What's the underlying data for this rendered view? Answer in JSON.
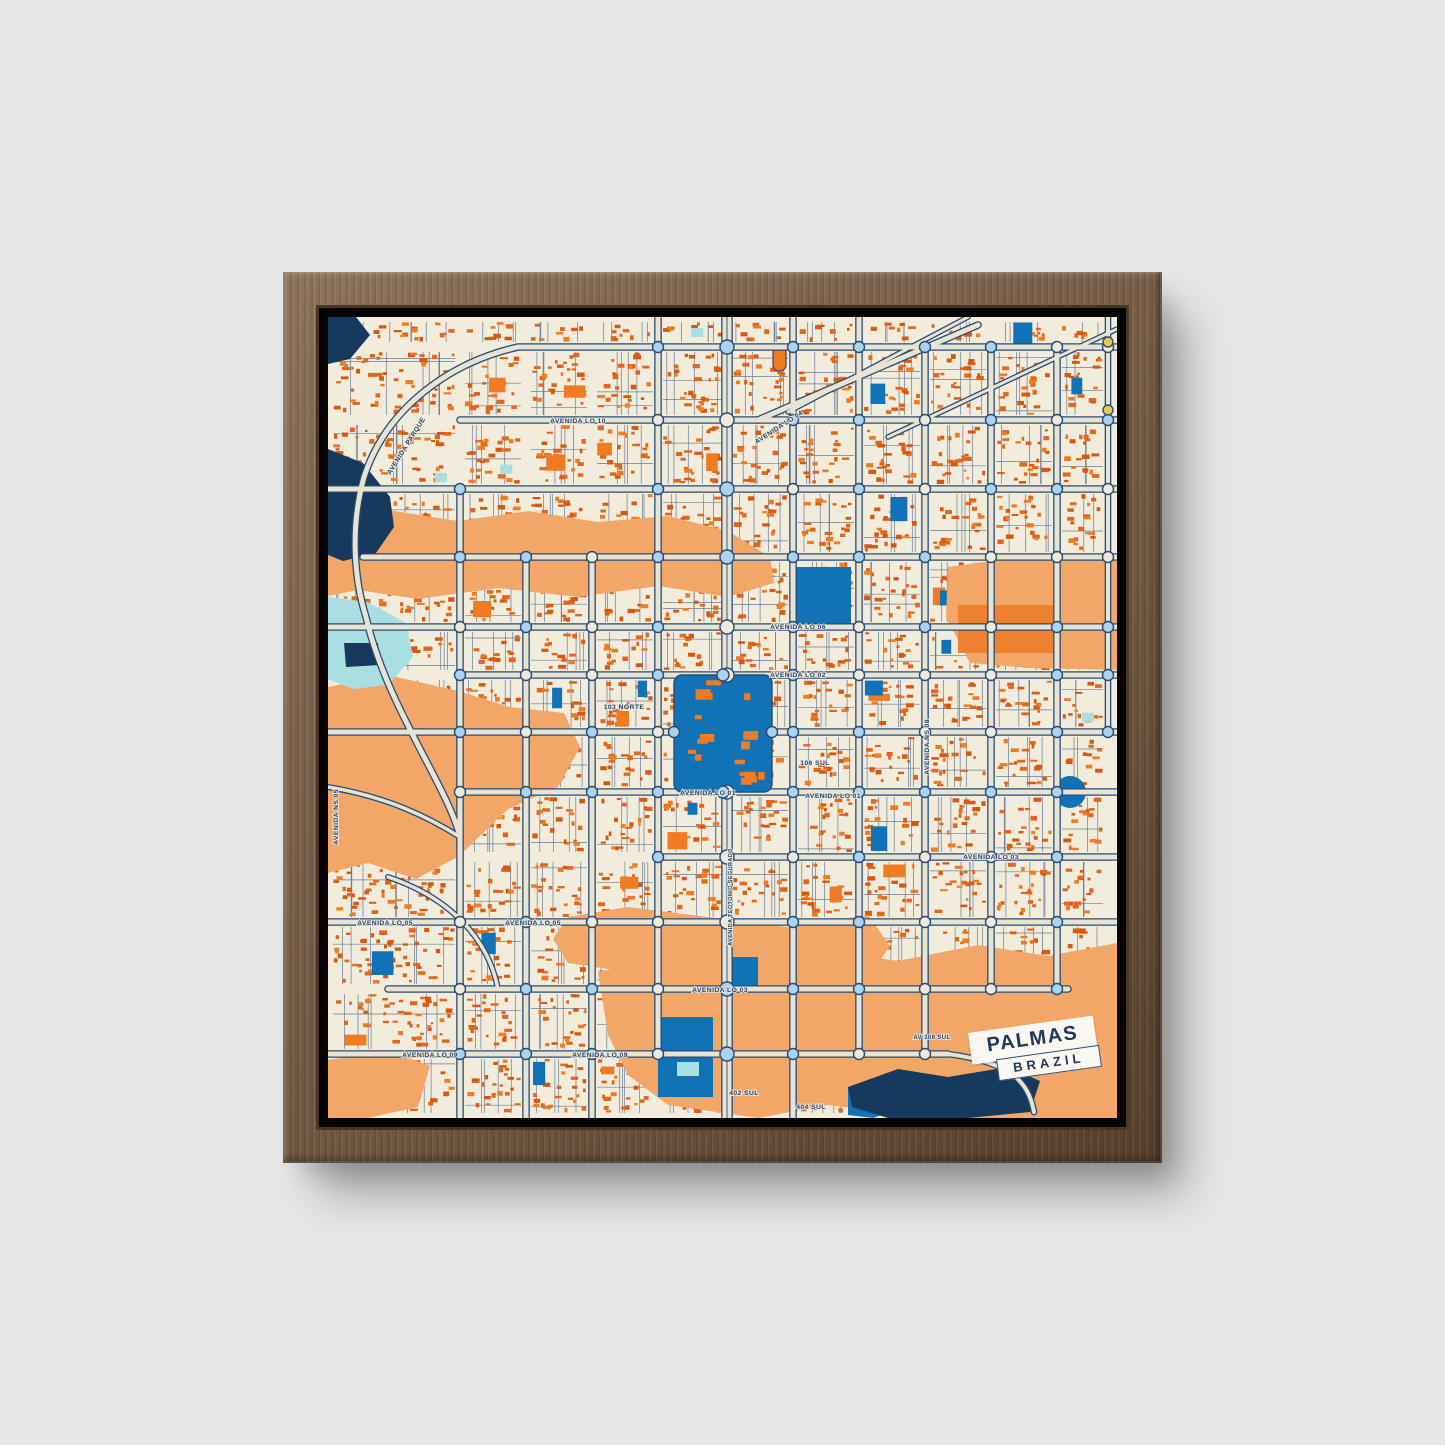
{
  "scene": {
    "wall_color": "#e7e7e7",
    "frame_wood_color": "#6e5640",
    "frame_gap_color": "#120c07"
  },
  "map": {
    "title_card": {
      "title": "PALMAS",
      "subtitle": "BRAZIL"
    },
    "seed": 20240718,
    "palette": {
      "cream": "#f1ecdc",
      "minor_road": "#51688c",
      "building1": "#e2661c",
      "building2": "#d8580e",
      "building3": "#ef7b22",
      "blue": "#1173b6",
      "cyan": "#a9dfe0",
      "navy": "#17395e",
      "orange": "#f2a768",
      "orange_dark": "#ee8130",
      "road_fill": "#e8e4d4",
      "casing": "#2b4b72",
      "roundabout": "#a9d3ee",
      "roundabout_alt": "#efe9d9",
      "yellow": "#e9c94e",
      "label": "#24426e"
    },
    "patches": [
      {
        "c": "orange",
        "pts": "0,205 60,193 130,204 200,194 270,205 340,199 400,214 442,240 446,266 400,280 330,269 250,280 170,271 90,282 30,273 0,279"
      },
      {
        "c": "orange",
        "pts": "620,250 700,239 789,237 789,353 700,351 642,346 618,300"
      },
      {
        "c": "orange",
        "pts": "0,370 60,358 130,374 182,390 236,396 252,430 230,470 180,492 130,540 88,562 40,546 0,556"
      },
      {
        "c": "orange",
        "pts": "225,622 240,600 300,590 380,600 460,610 540,598 562,629 540,660 460,650 380,662 300,655 240,646"
      },
      {
        "c": "orange",
        "pts": "270,655 350,638 430,649 500,633 570,644 650,628 720,639 789,626 789,801 600,801 500,788 430,801 340,788 300,758 280,718"
      },
      {
        "c": "orange",
        "pts": "0,743 60,733 102,749 90,790 40,801 0,801"
      },
      {
        "c": "navy",
        "pts": "0,0 28,0 42,18 22,42 0,47"
      },
      {
        "c": "navy",
        "pts": "0,132 35,146 62,180 66,210 48,236 15,244 0,238"
      },
      {
        "c": "cyan",
        "pts": "0,280 40,285 78,306 85,340 60,368 25,372 0,362"
      },
      {
        "c": "navy",
        "pts": "16,326 50,326 52,348 18,350"
      },
      {
        "c": "blue",
        "pts": "520,770 560,757 577,790 545,801 520,798"
      },
      {
        "c": "navy",
        "pts": "520,770 570,752 620,760 680,750 712,764 702,795 640,801 560,801 524,790"
      }
    ],
    "shapes": [
      {
        "type": "rect",
        "x": 630,
        "y": 288,
        "w": 95,
        "h": 48,
        "c": "orange_dark"
      },
      {
        "type": "rect",
        "x": 468,
        "y": 250,
        "w": 55,
        "h": 58,
        "c": "blue"
      },
      {
        "type": "rect",
        "x": 330,
        "y": 700,
        "w": 55,
        "h": 80,
        "c": "blue"
      },
      {
        "type": "rect",
        "x": 404,
        "y": 640,
        "w": 26,
        "h": 30,
        "c": "blue"
      },
      {
        "type": "rect",
        "x": 349,
        "y": 745,
        "w": 22,
        "h": 14,
        "c": "cyan"
      },
      {
        "type": "circle",
        "cx": 742,
        "cy": 475,
        "r": 16,
        "c": "blue"
      },
      {
        "type": "rect",
        "x": 445,
        "y": 28,
        "w": 13,
        "h": 26,
        "c": "building3",
        "rx": 6,
        "stroke": 1
      }
    ],
    "roads": {
      "horizontals": [
        {
          "y": 30,
          "x0": 190,
          "x1": 789,
          "w": 5
        },
        {
          "y": 103,
          "x0": 132,
          "x1": 789,
          "w": 5
        },
        {
          "y": 172,
          "x0": 0,
          "x1": 789,
          "w": 5
        },
        {
          "y": 240,
          "x0": 35,
          "x1": 789,
          "w": 5
        },
        {
          "y": 310,
          "x0": 0,
          "x1": 789,
          "w": 5
        },
        {
          "y": 358,
          "x0": 132,
          "x1": 789,
          "w": 5
        },
        {
          "y": 415,
          "x0": 0,
          "x1": 346,
          "w": 5
        },
        {
          "y": 415,
          "x0": 444,
          "x1": 789,
          "w": 5
        },
        {
          "y": 475,
          "x0": 132,
          "x1": 789,
          "w": 5
        },
        {
          "y": 540,
          "x0": 330,
          "x1": 789,
          "w": 5
        },
        {
          "y": 605,
          "x0": 0,
          "x1": 789,
          "w": 5
        },
        {
          "y": 672,
          "x0": 60,
          "x1": 740,
          "w": 5
        },
        {
          "y": 737,
          "x0": 0,
          "x1": 620,
          "w": 5
        }
      ],
      "verticals": [
        {
          "x": 132,
          "y0": 172,
          "y1": 801,
          "w": 5
        },
        {
          "x": 198,
          "y0": 240,
          "y1": 801,
          "w": 5
        },
        {
          "x": 264,
          "y0": 240,
          "y1": 801,
          "w": 5
        },
        {
          "x": 330,
          "y0": 0,
          "y1": 737,
          "w": 5
        },
        {
          "x": 399,
          "y0": 0,
          "y1": 801,
          "w": 9
        },
        {
          "x": 465,
          "y0": 0,
          "y1": 801,
          "w": 5
        },
        {
          "x": 531,
          "y0": 0,
          "y1": 737,
          "w": 5
        },
        {
          "x": 597,
          "y0": 30,
          "y1": 737,
          "w": 5
        },
        {
          "x": 663,
          "y0": 30,
          "y1": 672,
          "w": 5
        },
        {
          "x": 729,
          "y0": 30,
          "y1": 672,
          "w": 5
        },
        {
          "x": 780,
          "y0": 0,
          "y1": 415,
          "w": 4
        }
      ],
      "curves": [
        {
          "d": "M190,30 C120,46 58,92 36,160 C22,210 26,262 38,300 C58,388 120,470 132,520",
          "w": 5
        },
        {
          "d": "M430,103 L650,8",
          "w": 5
        },
        {
          "d": "M460,95 L640,0",
          "w": 3
        },
        {
          "d": "M560,120 L789,12",
          "w": 3
        },
        {
          "d": "M60,560 C120,580 160,620 170,672",
          "w": 3.5
        },
        {
          "d": "M0,470 C60,480 100,500 132,520",
          "w": 3.5
        },
        {
          "d": "M620,737 C680,745 700,762 706,795",
          "w": 4
        }
      ]
    },
    "central_square": {
      "x": 346,
      "y": 358,
      "w": 98,
      "h": 117
    },
    "extra_roundabouts": [
      {
        "x": 346,
        "y": 415,
        "r": 5.5
      },
      {
        "x": 444,
        "y": 415,
        "r": 5.5
      },
      {
        "x": 395,
        "y": 358,
        "r": 6
      },
      {
        "x": 395,
        "y": 475,
        "r": 6
      },
      {
        "x": 780,
        "y": 25,
        "r": 5,
        "fill": "yellow"
      },
      {
        "x": 780,
        "y": 93,
        "r": 5,
        "fill": "yellow"
      }
    ],
    "street_labels": [
      {
        "t": "AVENIDA LO 10",
        "x": 250,
        "y": 106
      },
      {
        "t": "AVENIDA LO 04",
        "x": 452,
        "y": 112,
        "rot": -33
      },
      {
        "t": "AVENIDA PARQUE",
        "x": 80,
        "y": 130,
        "rot": -58
      },
      {
        "t": "AVENIDA LO 06",
        "x": 470,
        "y": 312
      },
      {
        "t": "AVENIDA LO 02",
        "x": 470,
        "y": 360
      },
      {
        "t": "103 NORTE",
        "x": 296,
        "y": 392
      },
      {
        "t": "106 SUL",
        "x": 487,
        "y": 448
      },
      {
        "t": "AVENIDA LO 01",
        "x": 380,
        "y": 478
      },
      {
        "t": "AVENIDA LO 01",
        "x": 505,
        "y": 481
      },
      {
        "t": "AVENIDA LO 03",
        "x": 663,
        "y": 542
      },
      {
        "t": "AVENIDA LO 05",
        "x": 57,
        "y": 608
      },
      {
        "t": "AVENIDA LO 05",
        "x": 205,
        "y": 608
      },
      {
        "t": "AVENIDA LO 03",
        "x": 392,
        "y": 675
      },
      {
        "t": "AVENIDA LO 09",
        "x": 102,
        "y": 740
      },
      {
        "t": "AVENIDA LO 09",
        "x": 272,
        "y": 740
      },
      {
        "t": "402 SUL",
        "x": 416,
        "y": 778
      },
      {
        "t": "404 SUL",
        "x": 483,
        "y": 792
      },
      {
        "t": "AV 308 SUL",
        "x": 604,
        "y": 722,
        "size": 6
      },
      {
        "t": "AVENIDA NS 08",
        "x": 601,
        "y": 430,
        "rot": -90
      },
      {
        "t": "AVENIDA NS 05",
        "x": 10,
        "y": 500,
        "rot": -90
      },
      {
        "t": "AVENIDA TEOTONIO SEGURADO",
        "x": 404,
        "y": 580,
        "rot": -90,
        "size": 5.5
      }
    ]
  }
}
